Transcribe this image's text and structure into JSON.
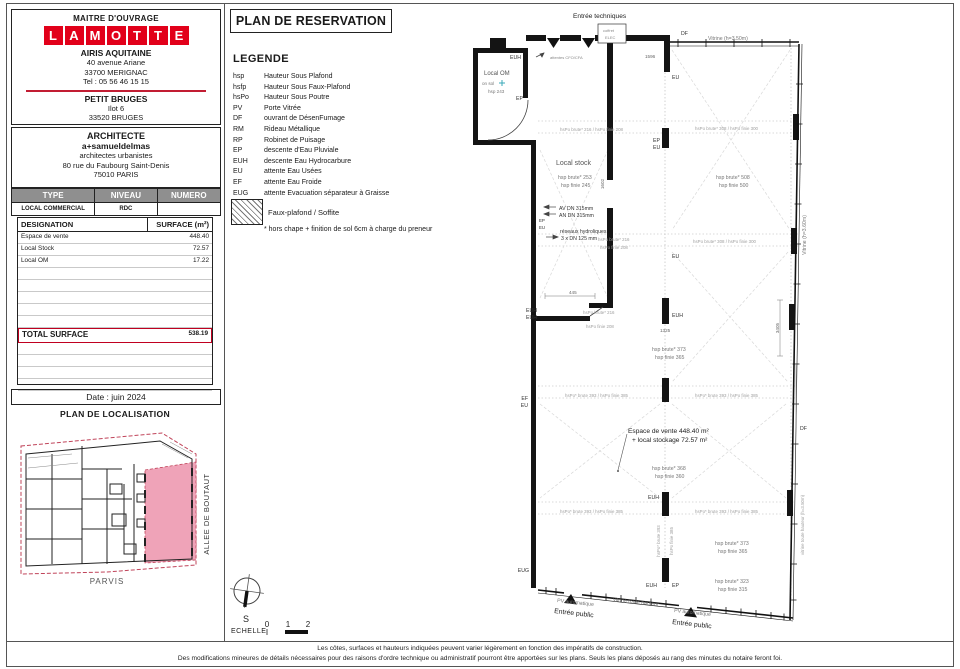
{
  "header": {
    "maitre_label": "MAITRE D'OUVRAGE",
    "logo_letters": [
      "L",
      "A",
      "M",
      "O",
      "T",
      "T",
      "E"
    ],
    "company": "AIRIS AQUITAINE",
    "address1": "40 avenue Ariane",
    "address2": "33700 MERIGNAC",
    "tel": "Tel : 05 56 46 15 15",
    "project": "PETIT BRUGES",
    "ilot": "Ilot 6",
    "city": "33520 BRUGES"
  },
  "architect": {
    "title": "ARCHITECTE",
    "name": "a+samueldelmas",
    "subtitle": "architectes urbanistes",
    "address1": "80 rue du Faubourg Saint-Denis",
    "address2": "75010 PARIS"
  },
  "type_table": {
    "h1": "TYPE",
    "h2": "NIVEAU",
    "h3": "NUMERO",
    "r1": "LOCAL COMMERCIAL",
    "r2": "RDC",
    "r3": ""
  },
  "surface_table": {
    "col1": "DESIGNATION",
    "col2": "SURFACE (m²)",
    "rows": [
      {
        "label": "Espace de vente",
        "value": "448.40"
      },
      {
        "label": "Local Stock",
        "value": "72.57"
      },
      {
        "label": "Local OM",
        "value": "17.22"
      }
    ],
    "total_label": "TOTAL SURFACE",
    "total_value": "538.19"
  },
  "date": "Date : juin 2024",
  "localisation": {
    "title": "PLAN DE LOCALISATION",
    "street": "ALLEE DE BOUTAUT",
    "parvis": "PARVIS",
    "highlight_color": "#efa3b8",
    "boundary_color": "#c0445a"
  },
  "sheet_title": "PLAN DE RESERVATION",
  "legend": {
    "title": "LEGENDE",
    "items": [
      {
        "ab": "hsp",
        "de": "Hauteur Sous Plafond"
      },
      {
        "ab": "hsfp",
        "de": "Hauteur Sous Faux-Plafond"
      },
      {
        "ab": "hsPo",
        "de": "Hauteur Sous Poutre"
      },
      {
        "ab": "PV",
        "de": "Porte Vitrée"
      },
      {
        "ab": "DF",
        "de": "ouvrant de DésenFumage"
      },
      {
        "ab": "RM",
        "de": "Rideau Métallique"
      },
      {
        "ab": "RP",
        "de": "Robinet de Puisage"
      },
      {
        "ab": "EP",
        "de": "descente d'Eau Pluviale"
      },
      {
        "ab": "EUH",
        "de": "descente Eau Hydrocarbure"
      },
      {
        "ab": "EU",
        "de": "attente Eau Usées"
      },
      {
        "ab": "EF",
        "de": "attente Eau Froide"
      },
      {
        "ab": "EUG",
        "de": "attente Evacuation séparateur à Graisse"
      }
    ],
    "hatch_label": "Faux-plafond / Soffite",
    "note": "* hors chape + finition de sol 6cm à charge du preneur"
  },
  "scale": {
    "label": "ECHELLE",
    "t0": "0",
    "t1": "1",
    "t2": "2",
    "south": "S"
  },
  "footer": {
    "line1": "Les côtes, surfaces et hauteurs indiquées peuvent varier légèrement en fonction des impératifs de construction.",
    "line2": "Des modifications mineures de détails nécessaires pour des raisons d'ordre technique ou administratif pourront être apportées sur les plans. Seuls les plans déposés au rang des minutes du notaire feront foi."
  },
  "plan": {
    "entree_techniques": "Entrée techniques",
    "coffret1": "coffret",
    "coffret2": "ELEC",
    "df": "DF",
    "vitrine_top": "Vitrine (h=3.50m)",
    "vitrine_right": "Vitrine (h=3.60m)",
    "vitrine_bottom_right": "vitrine toute hauteur (h=3.50m)",
    "vitrine_bottom": "vitrine toute hauteur",
    "local_om": "Local OM",
    "on_sol": "on sol",
    "hsp_om": "hsp 243",
    "attentes": "attentes CFO/CFA",
    "local_stock": "Local stock",
    "stock_hsp1": "hsp brute* 253",
    "stock_hsp2": "hsp finie 245",
    "room_tr_hsp1": "hsp brute* 508",
    "room_tr_hsp2": "hsp finie 500",
    "band_216": "hsPo brute* 216 / hsPo finie 208",
    "band_308": "hsPo brute* 308 / hsPo finie 300",
    "band_393": "hsPo* brute 393 / hsPo finie 385",
    "stock_band1": "hsPo brute* 216",
    "stock_band2": "hsPo finie 208",
    "post_v1": "hsPo* brute 393",
    "post_v2": "hsPo finie 385",
    "hsp_373": "hsp brute* 373",
    "hsp_365": "hsp finie 365",
    "hsp_368": "hsp brute* 368",
    "hsp_360": "hsp finie 360",
    "hsp_323": "hsp brute* 323",
    "hsp_315": "hsp finie 315",
    "espace1": "Espace de vente 448.40 m²",
    "espace2": "+ local stockage 72.57 m²",
    "av_dn": "AV DN 315mm",
    "an_dn": "AN DN 315mm",
    "reseaux": "réseaux hydroliques",
    "dn125": "3 x DN 125 mm",
    "dim_1596": "1596",
    "dim_1602": "1602",
    "dim_445": "445",
    "dim_1325": "1325",
    "dim_3405": "3405",
    "euh": "EUH",
    "ep": "EP",
    "eu": "EU",
    "ef": "EF",
    "eug": "EUG",
    "pv_auto": "PV automatique",
    "entree_public": "Entrée public"
  }
}
